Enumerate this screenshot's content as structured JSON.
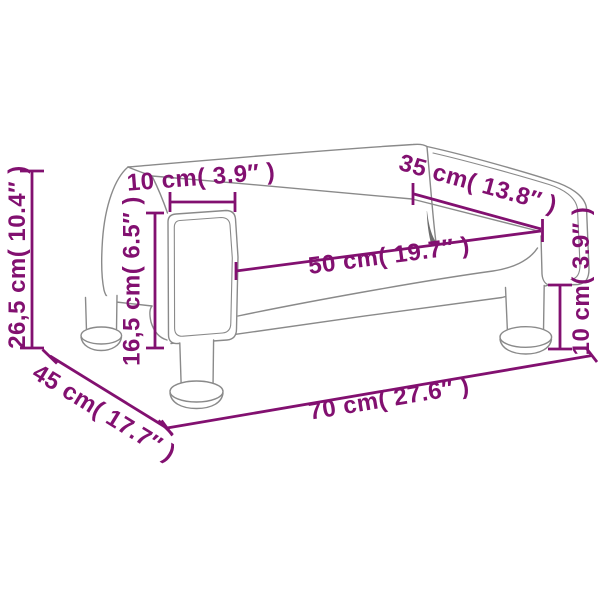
{
  "diagram": {
    "type": "product-dimension-diagram",
    "subject": "sofa line drawing with measurement annotations",
    "colors": {
      "dimension_annotation": "#821070",
      "outline_gray": "#8a8a8a",
      "background": "#ffffff"
    },
    "dims": {
      "armrest_width_top": "10 cm( 3.9″ )",
      "back_length": "35 cm( 13.8″ )",
      "seat_width": "50 cm( 19.7″ )",
      "total_height": "26,5 cm( 10.4″ )",
      "armrest_height": "16,5 cm( 6.5″ )",
      "leg_height": "10 cm( 3.9″ )",
      "total_width": "70 cm( 27.6″ )",
      "total_depth": "45 cm( 17.7″ )"
    }
  }
}
